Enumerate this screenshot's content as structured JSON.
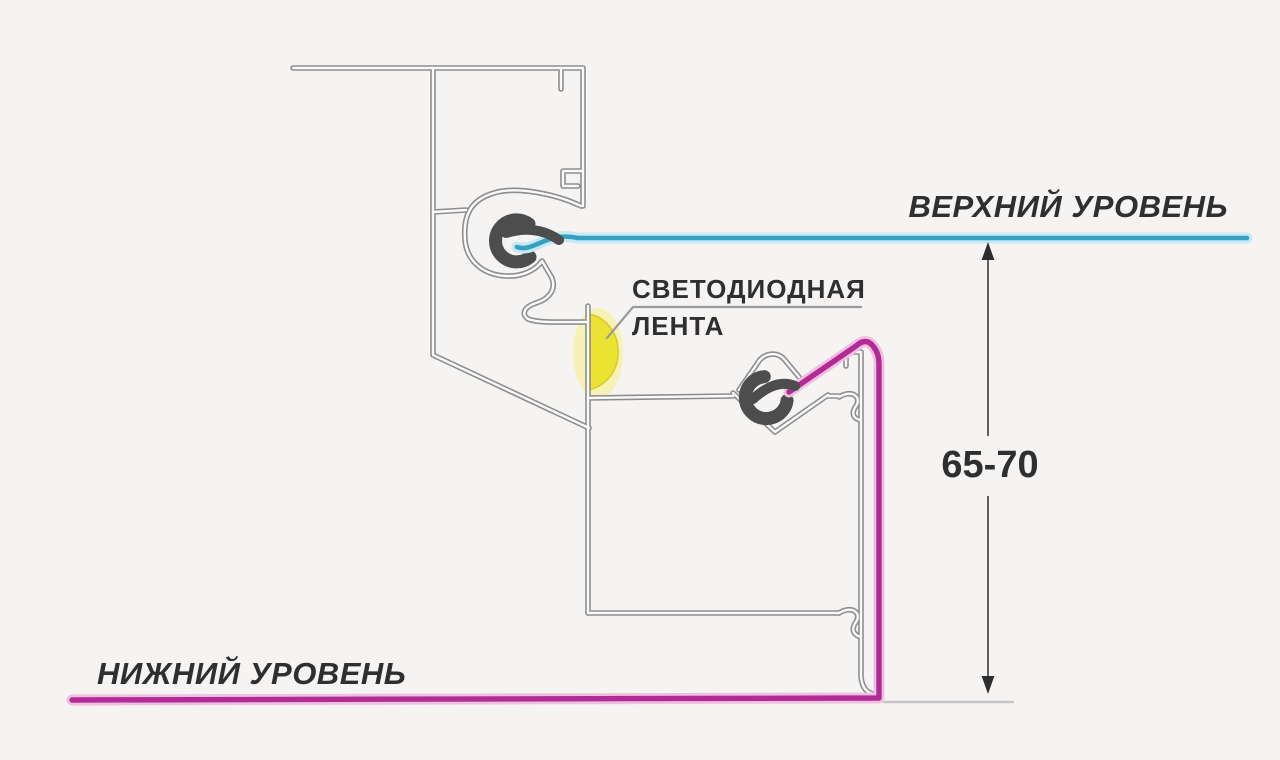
{
  "labels": {
    "upper_level": "ВЕРХНИЙ УРОВЕНЬ",
    "led_strip": [
      "СВЕТОДИОДНАЯ",
      "ЛЕНТА"
    ],
    "lower_level": "НИЖНИЙ УРОВЕНЬ",
    "dimension_value": "65-70"
  },
  "colors": {
    "background": "#f5f4f2",
    "upper_level_line": "#35a0c2",
    "upper_level_glow": "#c6e9f3",
    "lower_level_line": "#b12a96",
    "lower_level_glow": "#eec0e0",
    "led_fill": "#ece231",
    "led_glow": "#f6f0a4",
    "profile_stroke": "#8e8e8e",
    "profile_inner": "#fafafa",
    "clip_fill": "#4d4d4d",
    "text": "#2f2f2f",
    "dimension": "#606060",
    "leader": "#9a9a9a",
    "baseline": "#c6c6c6"
  }
}
